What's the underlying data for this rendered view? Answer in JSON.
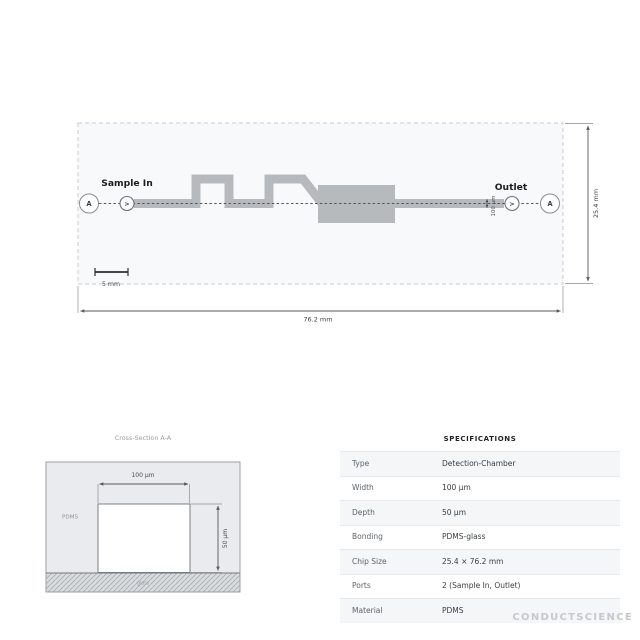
{
  "colors": {
    "chip_fill": "#f8f9fa",
    "chip_border": "#c9cdd1",
    "channel": "#b7babd",
    "chamber": "#b7babd",
    "dimension": "#55585c",
    "panel_fill": "#e9ebee",
    "channel_cavity": "#ffffff"
  },
  "diagram": {
    "sample_in_label": "Sample In",
    "outlet_label": "Outlet",
    "section_marker_left": "A",
    "section_marker_right": "A",
    "inlet_port_glyph": ">",
    "outlet_port_glyph": ">",
    "channel_width_label": "100 µm",
    "chip_height_label": "25.4 mm",
    "chip_width_label": "76.2 mm",
    "scale_bar_label": "5 mm"
  },
  "cross_section": {
    "title": "Cross-Section A-A",
    "width_label": "100 µm",
    "depth_label": "50 µm",
    "bulk_material_label": "PDMS",
    "substrate_label": "glass"
  },
  "specifications": {
    "title": "SPECIFICATIONS",
    "rows": [
      {
        "label": "Type",
        "value": "Detection-Chamber"
      },
      {
        "label": "Width",
        "value": "100 µm"
      },
      {
        "label": "Depth",
        "value": "50 µm"
      },
      {
        "label": "Bonding",
        "value": "PDMS-glass"
      },
      {
        "label": "Chip Size",
        "value": "25.4 × 76.2 mm"
      },
      {
        "label": "Ports",
        "value": "2 (Sample In, Outlet)"
      },
      {
        "label": "Material",
        "value": "PDMS"
      }
    ]
  },
  "watermark": "CONDUCTSCIENCE"
}
